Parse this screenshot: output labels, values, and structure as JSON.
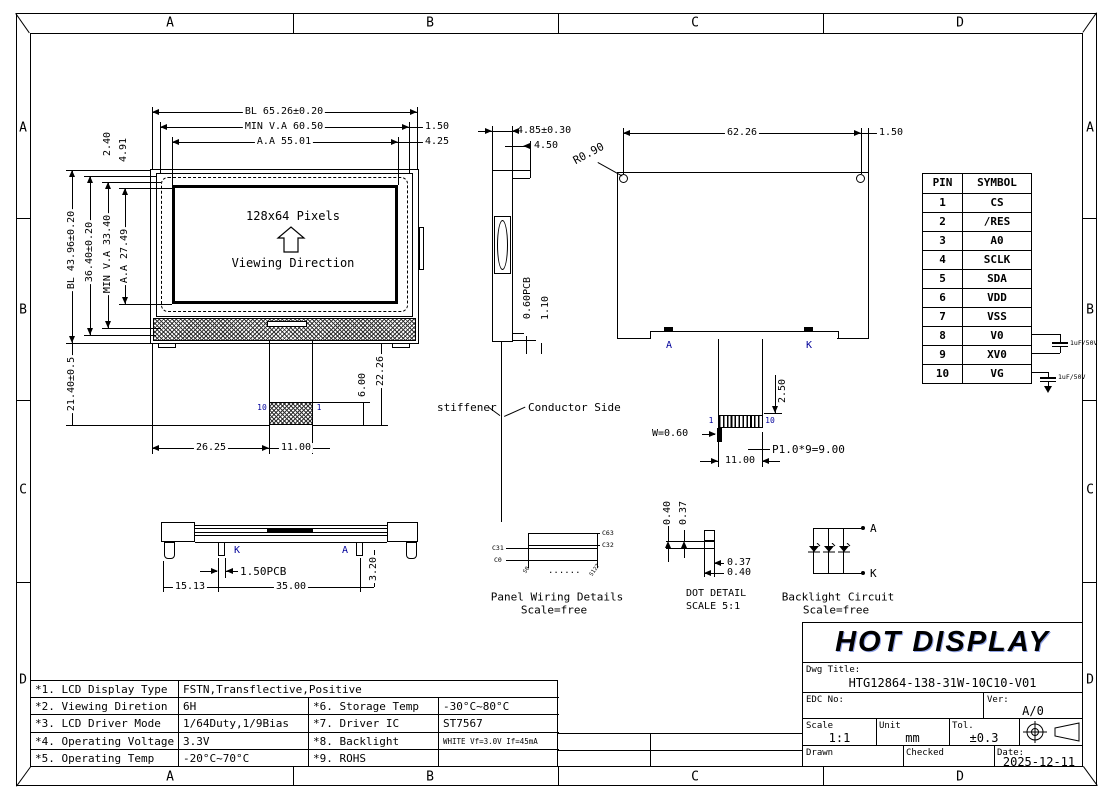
{
  "colors": {
    "annotation_blue": "#00009a"
  },
  "zones": {
    "top": [
      "A",
      "B",
      "C",
      "D"
    ],
    "bottom": [
      "A",
      "B",
      "C",
      "D"
    ],
    "left": [
      "A",
      "B",
      "C",
      "D"
    ],
    "right": [
      "A",
      "B",
      "C",
      "D"
    ]
  },
  "front_view": {
    "screen_text": "128x64 Pixels",
    "direction_text": "Viewing Direction",
    "tail_pin_left": "10",
    "tail_pin_right": "1",
    "dim_bl_width": "BL 65.26±0.20",
    "dim_va_width": "MIN V.A 60.50",
    "dim_aa_width": "A.A 55.01",
    "dim_edge_right": "1.50",
    "dim_corner_right": "4.25",
    "dim_top_offset": "2.40",
    "dim_top_offset2": "4.91",
    "dim_bl_height": "BL 43.96±0.20",
    "dim_glass_height": "36.40±0.20",
    "dim_va_height": "MIN V.A 33.40",
    "dim_aa_height": "A.A 27.49",
    "dim_tail_height": "21.40±0.5",
    "dim_tail_left": "26.25",
    "dim_tail_width": "11.00",
    "dim_conn_height": "6.00",
    "dim_tail_total": "22.26"
  },
  "side_view": {
    "dim_thickness": "4.85±0.30",
    "dim_thickness2": "4.50",
    "dim_pcb": "0.60PCB",
    "dim_gap": "1.10",
    "label_stiffener": "stiffener",
    "label_conductor": "Conductor Side"
  },
  "back_view": {
    "dim_width": "62.26",
    "dim_hole_offset": "1.50",
    "dim_radius": "R0.90",
    "dim_conn_offset": "2.50",
    "dim_pin_width": "W=0.60",
    "dim_pitch": "P1.0*9=9.00",
    "dim_conn_width": "11.00",
    "pad_a": "A",
    "pad_k": "K",
    "pin_first": "1",
    "pin_last": "10"
  },
  "pin_table": {
    "headers": [
      "PIN",
      "SYMBOL"
    ],
    "rows": [
      [
        "1",
        "CS"
      ],
      [
        "2",
        "/RES"
      ],
      [
        "3",
        "A0"
      ],
      [
        "4",
        "SCLK"
      ],
      [
        "5",
        "SDA"
      ],
      [
        "6",
        "VDD"
      ],
      [
        "7",
        "VSS"
      ],
      [
        "8",
        "V0"
      ],
      [
        "9",
        "XV0"
      ],
      [
        "10",
        "VG"
      ]
    ],
    "cap1": "1uF/50V",
    "cap2": "1uF/50V"
  },
  "bottom_view": {
    "label_k": "K",
    "label_a": "A",
    "dim_pcb": "1.50PCB",
    "dim_left": "15.13",
    "dim_width": "35.00",
    "dim_height": "3.20"
  },
  "panel_wiring": {
    "title": "Panel Wiring Details",
    "scale": "Scale=free",
    "c63": "C63",
    "c32": "C32",
    "c31": "C31",
    "c0": "C0",
    "s0": "S0",
    "dots": "......",
    "s127": "S127"
  },
  "dot_detail": {
    "title": "DOT DETAIL",
    "scale": "SCALE 5:1",
    "dim_v1": "0.40",
    "dim_v2": "0.37",
    "dim_h1": "0.37",
    "dim_h2": "0.40"
  },
  "backlight_circuit": {
    "title": "Backlight Circuit",
    "scale": "Scale=free",
    "anode": "A",
    "cathode": "K"
  },
  "spec_table": {
    "rows": [
      {
        "no": "*1. LCD Display Type",
        "v1": "FSTN,Transflective,Positive",
        "no2": "",
        "v2": ""
      },
      {
        "no": "*2. Viewing Diretion",
        "v1": "6H",
        "no2": "*6. Storage Temp",
        "v2": "-30°C~80°C"
      },
      {
        "no": "*3. LCD Driver Mode",
        "v1": "1/64Duty,1/9Bias",
        "no2": "*7. Driver IC",
        "v2": "ST7567"
      },
      {
        "no": "*4. Operating Voltage",
        "v1": "3.3V",
        "no2": "*8. Backlight",
        "v2": "WHITE Vf=3.0V If=45mA"
      },
      {
        "no": "*5. Operating Temp",
        "v1": "-20°C~70°C",
        "no2": "*9. ROHS",
        "v2": ""
      }
    ]
  },
  "title_block": {
    "company": "HOT DISPLAY",
    "dwg_title_label": "Dwg Title:",
    "dwg_title": "HTG12864-138-31W-10C10-V01",
    "edc_label": "EDC No:",
    "ver_label": "Ver:",
    "ver": "A/0",
    "scale_label": "Scale",
    "scale": "1:1",
    "unit_label": "Unit",
    "unit": "mm",
    "tol_label": "Tol.",
    "tol": "±0.3",
    "drawn_label": "Drawn",
    "checked_label": "Checked",
    "date_label": "Date:",
    "date": "2025-12-11"
  }
}
